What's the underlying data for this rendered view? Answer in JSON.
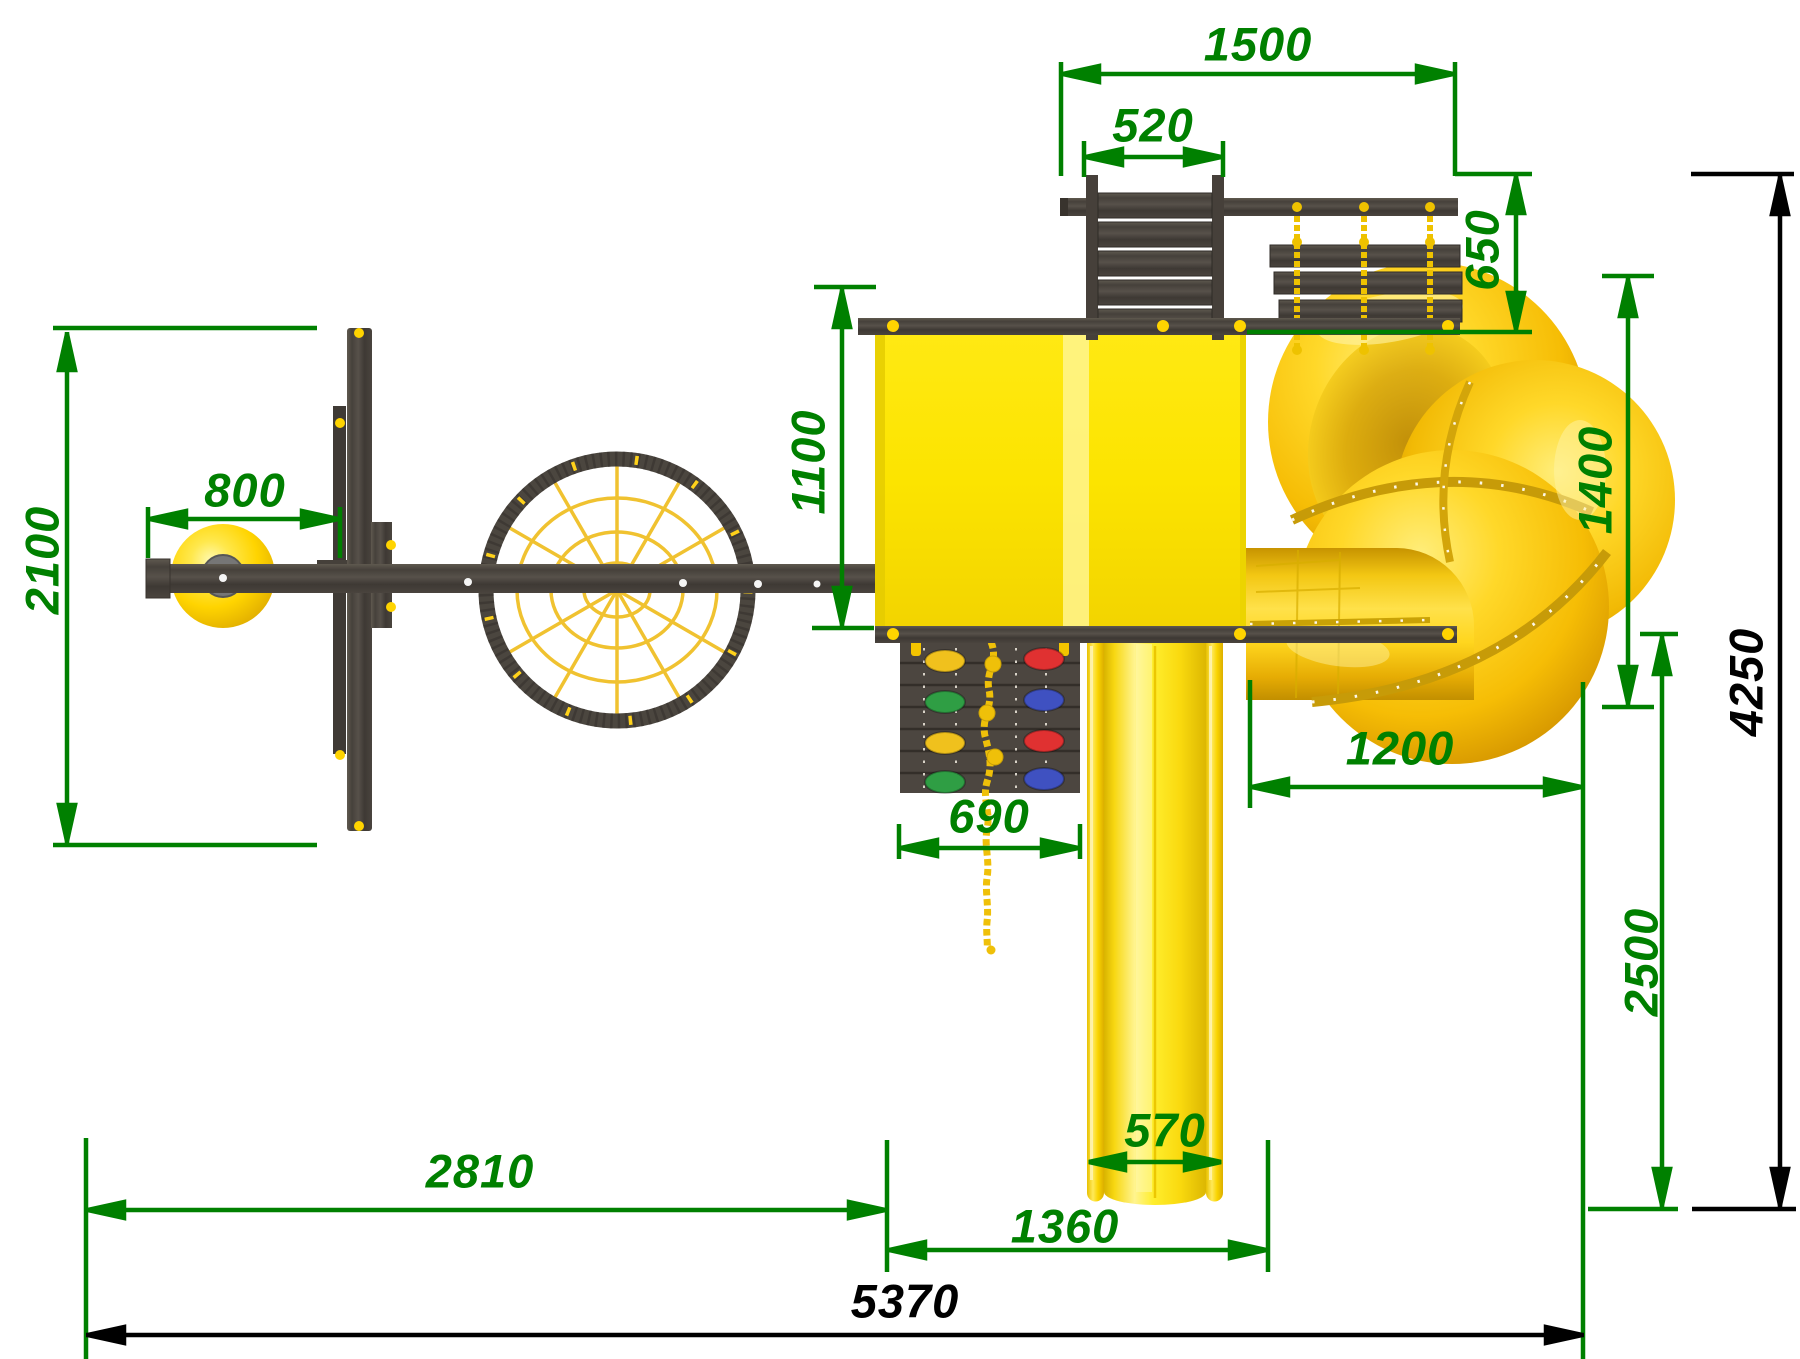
{
  "drawing": {
    "kind": "playground-equipment-top-view-dimension-drawing",
    "colors": {
      "dimension_detail": "#008000",
      "dimension_overall": "#000000",
      "wood_dark": "#4b453f",
      "plastic_yellow": "#ffd91e",
      "platform_yellow": "#fce400",
      "rope_yellow": "#eec200",
      "hold_red": "#e03131",
      "hold_blue": "#3f51c1",
      "hold_green": "#2f9e44",
      "hold_yellow": "#f0c11d"
    },
    "dims": {
      "top_span": "1500",
      "ladder_width": "520",
      "bridge_depth": "650",
      "swing_zone_depth": "2100",
      "swing_offset": "800",
      "platform_depth": "1100",
      "climb_wall_width": "690",
      "tube_zone_width": "1200",
      "tube_zone_depth": "1400",
      "slide_width": "570",
      "slide_zone_width": "1360",
      "swing_side_width": "2810",
      "runout_depth": "2500",
      "overall_depth": "4250",
      "overall_width": "5370"
    }
  }
}
